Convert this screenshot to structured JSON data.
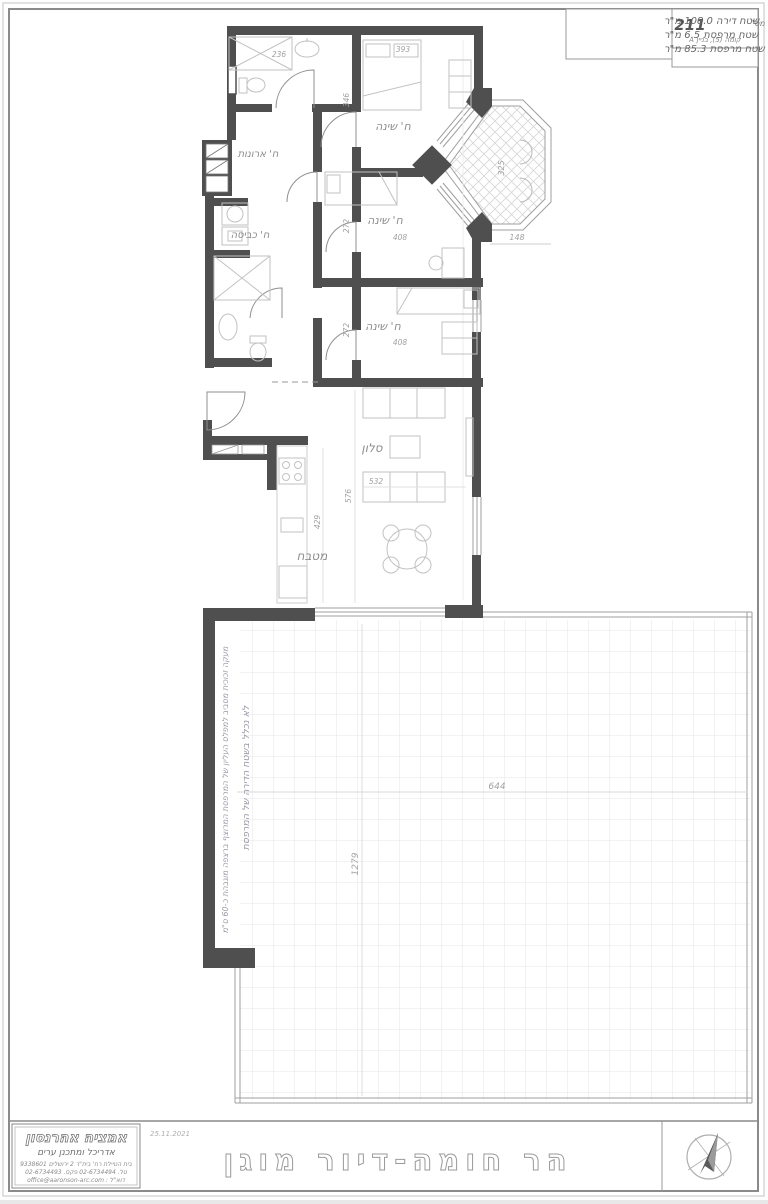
{
  "title_block": {
    "apt_label": "דירה מס'",
    "apt_number": "211",
    "floor": "קומה (5), בניין A",
    "area_lines": [
      "שטח דירה 108.0 מ\"ר",
      "שטח מרפסת 6.5 מ\"ר",
      "שטח מרפסת 85.3 מ\"ר"
    ]
  },
  "rooms": {
    "bedroom": "ח' שינה",
    "closet": "ח' ארונות",
    "laundry": "ח' כביסה",
    "living": "סלון",
    "kitchen": "מטבח"
  },
  "dims": {
    "d236": "236",
    "d393": "393",
    "d346": "346",
    "d272_a": "272",
    "d408_a": "408",
    "d272_b": "272",
    "d408_b": "408",
    "d532": "532",
    "d576": "576",
    "d429": "429",
    "d325": "325",
    "d148": "148",
    "d644": "644",
    "d1279": "1279"
  },
  "terrace_notes": {
    "line1": "מעקה זכוכית מסביב למפלס העליון של המרפסת המרוצף ברצפה מוגבהת כ-60 ס\"מ",
    "line2": "לא נכלל בשטח הדירה של המרפסת"
  },
  "footer": {
    "date": "25.11.2021",
    "project_title": "הר חומה-דיור מוגן",
    "architect_name": "אמציה אהרנסון",
    "architect_title": "אדריכל ומתכנן ערים",
    "address": "בית הטיילת רח' בית\"ר 2 ירושלים 9338601",
    "phones": "טל. 02-6734494 פקס. 02-6734493",
    "email": "דוא\"ל : office@aaronson-arc.com"
  },
  "colors": {
    "wall": "#4f4f4f",
    "furniture_line": "#c2c2c2",
    "dim_text": "#a2a2a2",
    "grid": "#e4e4e4",
    "border": "#8a8a8a"
  }
}
